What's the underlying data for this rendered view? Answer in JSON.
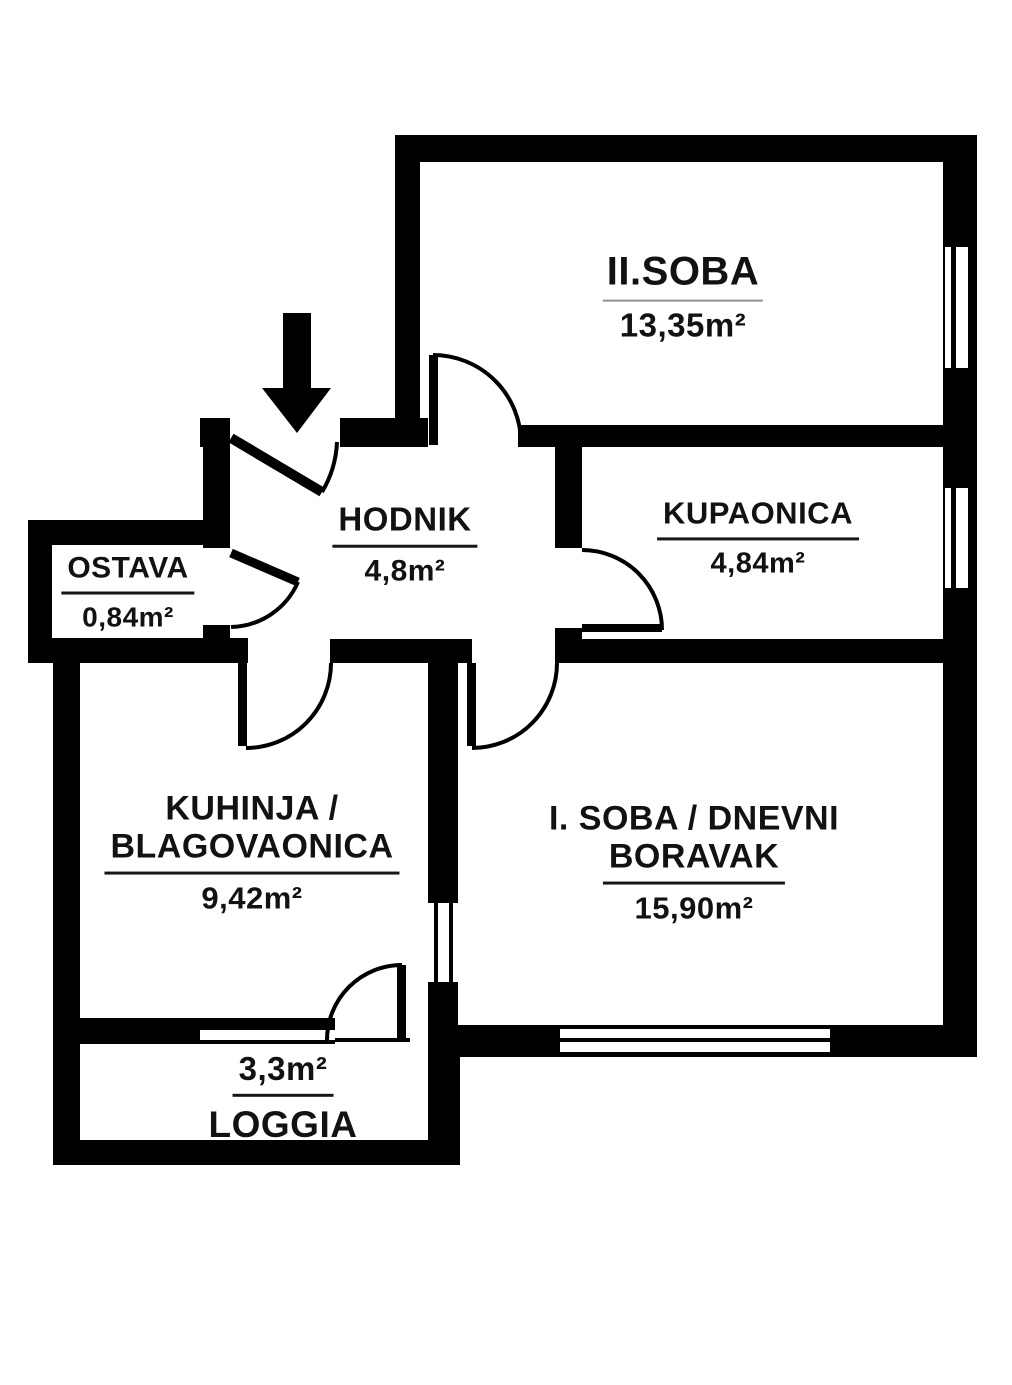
{
  "plan_title": "apartment floor plan",
  "colors": {
    "wall": "#000000",
    "background": "#ffffff",
    "text": "#121212"
  },
  "icons": {
    "entrance": "down-arrow-icon"
  },
  "rooms": [
    {
      "id": "soba2",
      "line1": "II.SOBA",
      "area": "13,35m²"
    },
    {
      "id": "kupaonica",
      "line1": "KUPAONICA",
      "area": "4,84m²"
    },
    {
      "id": "hodnik",
      "line1": "HODNIK",
      "area": "4,8m²"
    },
    {
      "id": "ostava",
      "line1": "OSTAVA",
      "area": "0,84m²"
    },
    {
      "id": "kuhinja",
      "line1": "KUHINJA /",
      "line2": "BLAGOVAONICA",
      "area": "9,42m²"
    },
    {
      "id": "soba1",
      "line1": "I. SOBA / DNEVNI",
      "line2": "BORAVAK",
      "area": "15,90m²"
    },
    {
      "id": "loggia",
      "line1": "LOGGIA",
      "area": "3,3m²",
      "area_position": "above"
    }
  ]
}
